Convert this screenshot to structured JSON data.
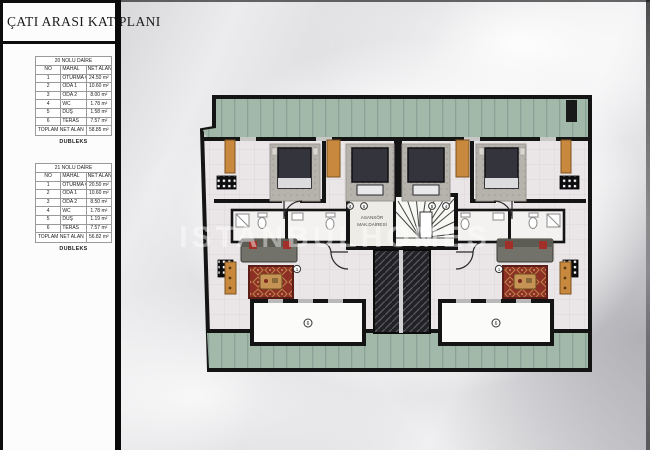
{
  "title": "ÇATI ARASI KAT PLANI",
  "tables": [
    {
      "title": "20 NOLU DAİRE",
      "columns": [
        "NO",
        "MAHAL",
        "NET ALAN"
      ],
      "rows": [
        [
          "1",
          "OTURMA ODASI",
          "24.50 m²"
        ],
        [
          "2",
          "ODA 1",
          "10.60 m²"
        ],
        [
          "3",
          "ODA 2",
          "8.00 m²"
        ],
        [
          "4",
          "WC",
          "1.78 m²"
        ],
        [
          "5",
          "DUŞ",
          "1.58 m²"
        ],
        [
          "6",
          "TERAS",
          "7.57 m²"
        ]
      ],
      "total_label": "TOPLAM NET ALAN",
      "total_value": "58.85 m²",
      "caption": "DUBLEKS"
    },
    {
      "title": "21 NOLU DAİRE",
      "columns": [
        "NO",
        "MAHAL",
        "NET ALAN"
      ],
      "rows": [
        [
          "1",
          "OTURMA ODASI",
          "20.50 m²"
        ],
        [
          "2",
          "ODA 1",
          "10.60 m²"
        ],
        [
          "3",
          "ODA 2",
          "8.50 m²"
        ],
        [
          "4",
          "WC",
          "1.78 m²"
        ],
        [
          "5",
          "DUŞ",
          "1.19 m²"
        ],
        [
          "6",
          "TERAS",
          "7.57 m²"
        ]
      ],
      "total_label": "TOPLAM NET ALAN",
      "total_value": "56.82 m²",
      "caption": "DUBLEKS"
    }
  ],
  "plan": {
    "machine_room_line1": "ASANSÖR",
    "machine_room_line2": "MAK.DAİRESİ",
    "watermark": "ISTANBULHOMES",
    "tags": {
      "living": "1",
      "wc": "4",
      "shower": "5",
      "roof": "6"
    },
    "colors": {
      "terrace_green": "#a2b9aa",
      "wall_black": "#141414",
      "wood_orange": "#c8893f",
      "carpet_red": "#8e2f25",
      "bed_dark": "#34343c",
      "floor_tile": "#eae6e7"
    }
  }
}
